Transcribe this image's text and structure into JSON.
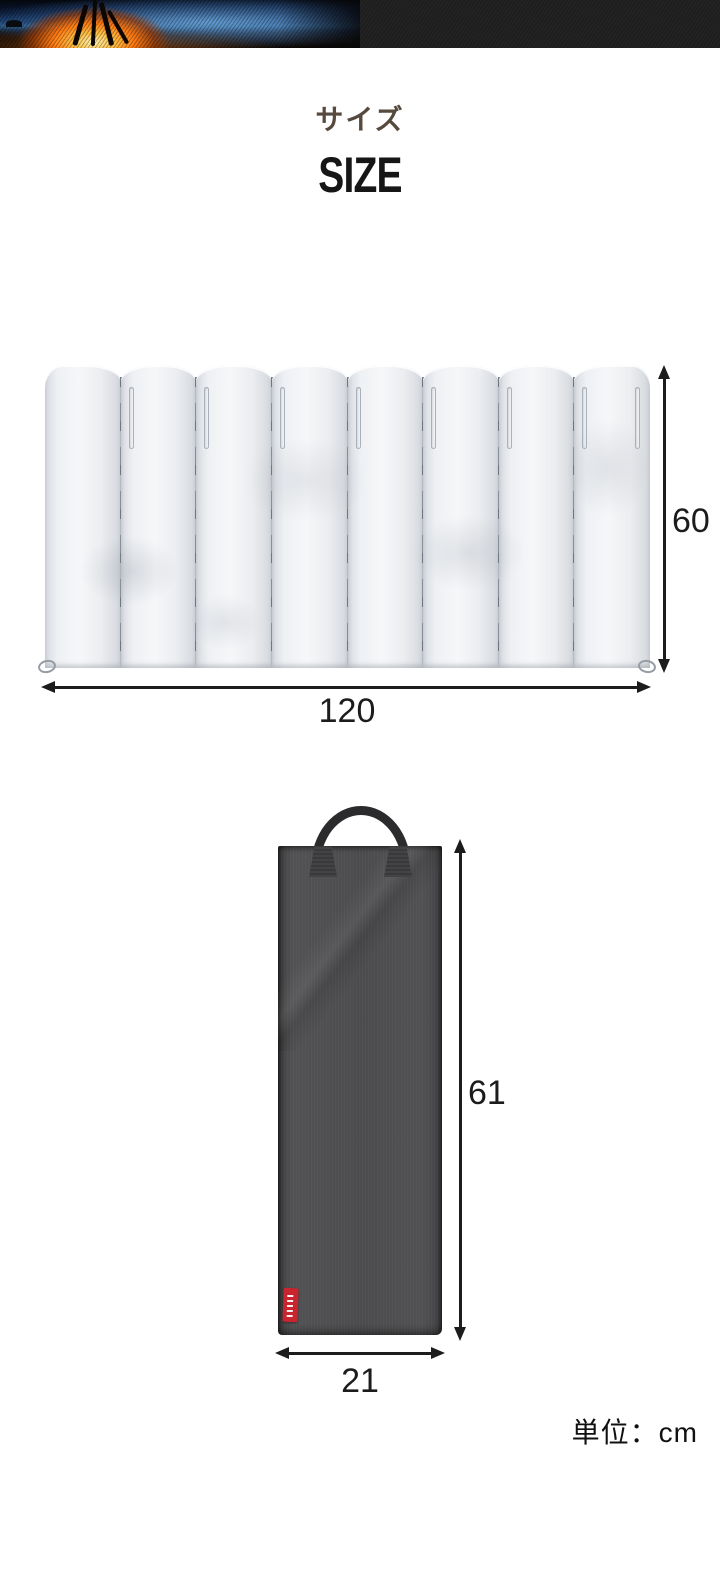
{
  "banner": {
    "photo": "campfire-on-beach-at-dusk",
    "right_panel_color": "#1e1e1e"
  },
  "heading": {
    "subtitle_jp": "サイズ",
    "subtitle_color": "#56493e",
    "title_en": "SIZE",
    "title_color": "#161616"
  },
  "windscreen": {
    "panel_count": 8,
    "height_value": "60",
    "width_value": "120"
  },
  "bag": {
    "height_value": "61",
    "width_value": "21",
    "tag_color": "#c9252f",
    "body_color": "#4c4c4e"
  },
  "unit_label": "単位：cm",
  "dimension_color": "#1c1c1c"
}
